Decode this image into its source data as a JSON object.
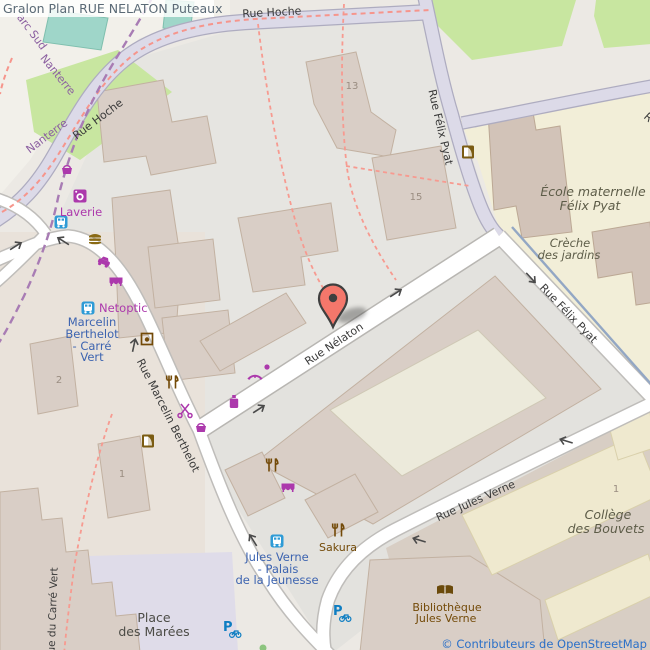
{
  "title": "Gralon Plan RUE NELATON Puteaux",
  "attribution": "© Contributeurs de OpenStreetMap",
  "streets": {
    "rue_hoche_top": "Rue Hoche",
    "rue_hoche_left": "Rue Hoche",
    "rue_felix_pyat_upper": "Rue Félix Pyat",
    "rue_felix_pyat_lower": "Rue Félix Pyat",
    "rue_nelaton": "Rue Nélaton",
    "rue_marcelin_berthelot": "Rue Marcelin Berthelot",
    "rue_jules_verne": "Rue Jules Verne",
    "rue_du_carre_vert": "Rue du Carré Vert",
    "partial_street_letter": "R"
  },
  "tram_labels": {
    "arc_sud": "arc Sud",
    "nanterre_1": "Nanterre",
    "nanterre_2": "Nanterre"
  },
  "bus_stops": {
    "marcelin_berthelot_carre_vert": {
      "line1": "Marcelin",
      "line2": "Berthelot",
      "line3": "- Carré",
      "line4": "Vert"
    },
    "jules_verne_palais": {
      "line1": "Jules Verne",
      "line2": "- Palais",
      "line3": "de la Jeunesse"
    }
  },
  "shops": {
    "laverie": "Laverie",
    "netoptic": "Netoptic"
  },
  "pois": {
    "sakura": "Sakura",
    "bibliotheque_line1": "Bibliothèque",
    "bibliotheque_line2": "Jules Verne",
    "ecole_line1": "École maternelle",
    "ecole_line2": "Félix Pyat",
    "creche_line1": "Crèche",
    "creche_line2": "des jardins",
    "college_line1": "Collège",
    "college_line2": "des Bouvets",
    "place_line1": "Place",
    "place_line2": "des Marées"
  },
  "building_numbers": {
    "n13": "13",
    "n15": "15",
    "n2": "2",
    "n1_west": "1",
    "n1_east": "1"
  },
  "colors": {
    "marker": "#f4776b",
    "shop_purple": "#ac39ac",
    "poi_brown": "#734a08",
    "transit_blue": "#3d64b0",
    "bus_icon_blue": "#2e9bd6",
    "bike_blue": "#0d7dc2",
    "road_white": "#ffffff",
    "road_lavender": "#dcdae8",
    "park_green": "#c8e6a0",
    "school_cream": "#f2eed8",
    "building_tan": "#d9cec6",
    "attribution_blue": "#2a70c8",
    "footpath_pink": "#f79a90",
    "tram_purple": "#a87cb4"
  }
}
